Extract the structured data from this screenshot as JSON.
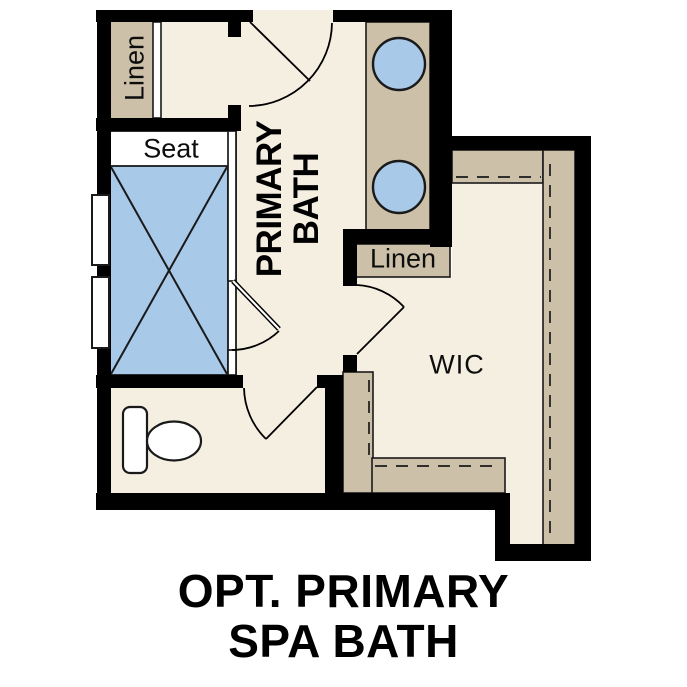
{
  "plan": {
    "labels": {
      "linen_top": "Linen",
      "seat": "Seat",
      "primary_bath_line1": "PRIMARY",
      "primary_bath_line2": "BATH",
      "linen_mid": "Linen",
      "wic": "WIC"
    },
    "title": {
      "line1": "OPT. PRIMARY",
      "line2": "SPA BATH"
    },
    "colors": {
      "wall": "#000000",
      "floor": "#f5efe2",
      "casework": "#ccc1a8",
      "fixture_blue": "#a9c9e9",
      "outline": "#1a1a1a"
    }
  }
}
